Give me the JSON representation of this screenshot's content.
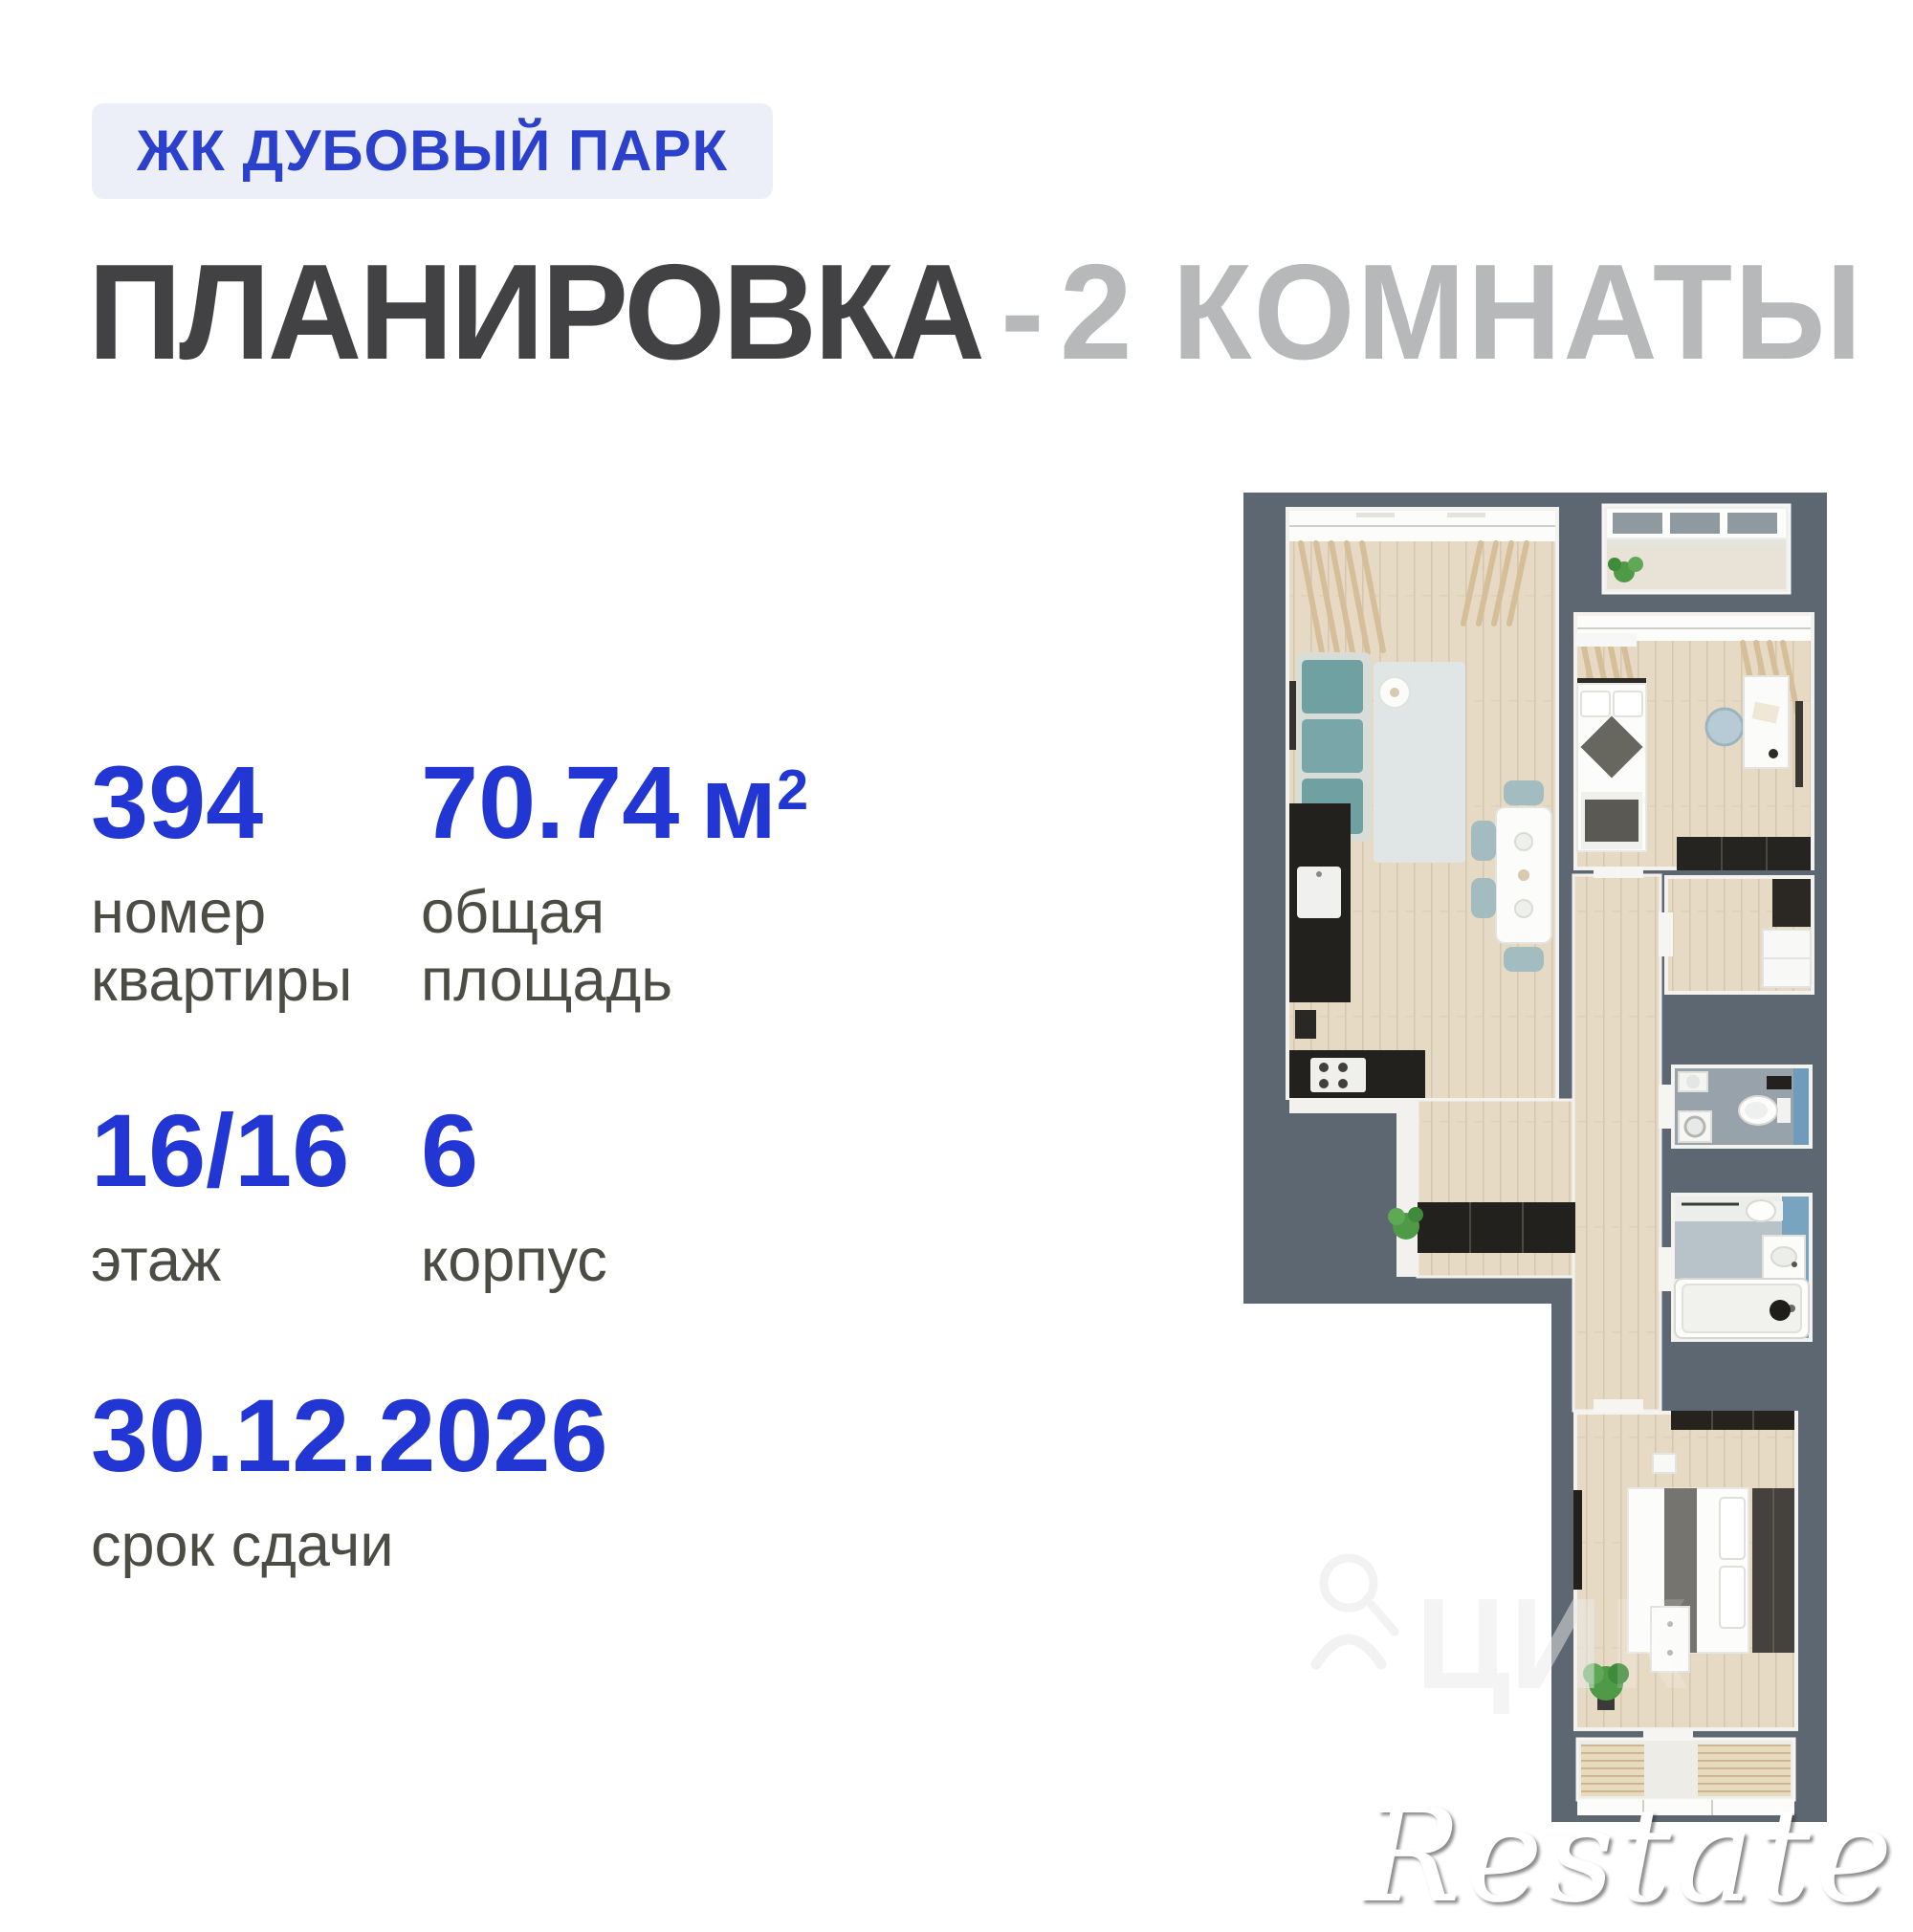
{
  "badge": {
    "label": "ЖК ДУБОВЫЙ ПАРК"
  },
  "title": {
    "dark": "ПЛАНИРОВКА",
    "separator": "-",
    "light": "2 КОМНАТЫ"
  },
  "stats": {
    "apartment_number": {
      "value": "394",
      "label_line1": "номер",
      "label_line2": "квартиры"
    },
    "total_area": {
      "value": "70.74",
      "unit": "м",
      "unit_sup": "2",
      "label_line1": "общая",
      "label_line2": "площадь"
    },
    "floor": {
      "value": "16/16",
      "label_line1": "этаж"
    },
    "building": {
      "value": "6",
      "label_line1": "корпус"
    },
    "completion_date": {
      "value": "30.12.2026",
      "label_line1": "срок сдачи"
    }
  },
  "floor_plan": {
    "type": "top-down 3d apartment plan, 2 rooms",
    "rooms": [
      "living-room-kitchen",
      "bedroom",
      "loggia-top",
      "hallway",
      "corridor",
      "storage",
      "wc",
      "bathroom",
      "bedroom-2",
      "loggia-bottom"
    ]
  },
  "watermarks": {
    "restate": "Restate"
  },
  "colors": {
    "accent_blue": "#2236d3",
    "badge_bg": "#edeff8",
    "badge_text": "#2b41cc",
    "title_dark": "#424245",
    "title_light": "#b6b8ba",
    "label_gray": "#4c4c45",
    "wall_gray": "#5c6771",
    "floor_wood": "#e7dac5",
    "bath_blue": "#78a4c0",
    "sofa_teal": "#6fa0a2"
  }
}
